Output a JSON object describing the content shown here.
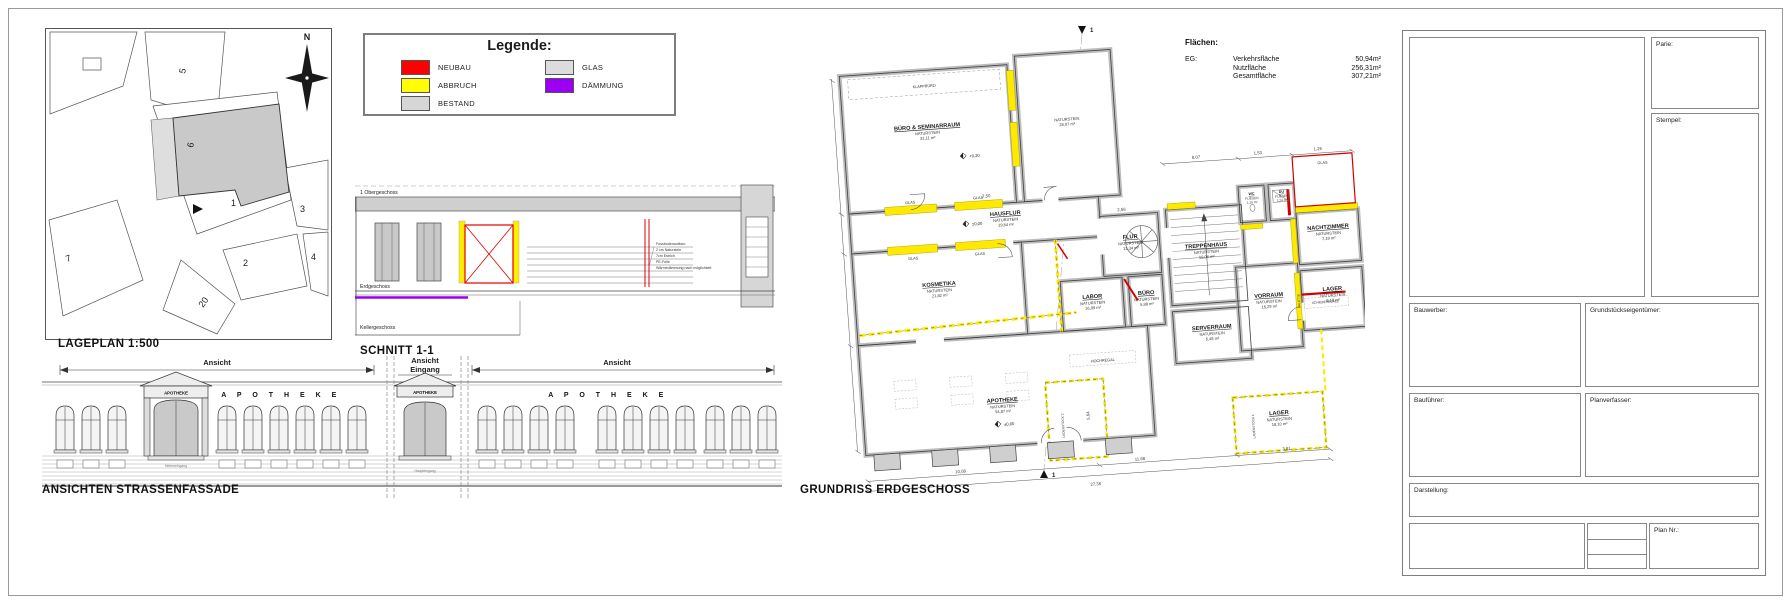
{
  "titles": {
    "lageplan": "LAGEPLAN 1:500",
    "schnitt": "SCHNITT 1-1",
    "ansichten": "ANSICHTEN STRASSENFASSADE",
    "grundriss": "GRUNDRISS ERDGESCHOSS"
  },
  "legende": {
    "title": "Legende:",
    "items": [
      {
        "label": "NEUBAU",
        "color": "#ff0000"
      },
      {
        "label": "ABBRUCH",
        "color": "#ffff00"
      },
      {
        "label": "BESTAND",
        "color": "#d6d6d6"
      },
      {
        "label": "GLAS",
        "color": "#dcdcdc"
      },
      {
        "label": "DÄMMUNG",
        "color": "#9b00f5"
      }
    ]
  },
  "lageplan": {
    "north": "N",
    "parcels": [
      "5",
      "6",
      "1",
      "3",
      "7",
      "2",
      "4",
      "20"
    ]
  },
  "schnitt": {
    "levels": [
      "1 Obergeschoss",
      "Erdgeschoss",
      "Kellergeschoss"
    ],
    "note": [
      "Fussbodenaufbau:",
      "2 cm Naturstein",
      "7cm Estrich",
      "PE-Folie",
      "Wärmedämmung nach möglichkeit"
    ]
  },
  "fassade": {
    "labels": {
      "left": "Ansicht",
      "mid1": "Ansicht",
      "mid2": "Eingang",
      "right": "Ansicht"
    },
    "lettering": "A P O T H E K E",
    "portal_sign": "APOTHEKE",
    "notes": {
      "left": "Nebeneingang",
      "mid": "Haupteingang"
    }
  },
  "grundriss": {
    "section_marker": "1",
    "rooms": [
      {
        "name": "BÜRO & SEMINARRAUM",
        "material": "NATURSTEIN",
        "area": "31,11 m²"
      },
      {
        "name": "PERSONALRAUM",
        "material": "NATURSTEIN",
        "area": "28,07 m²"
      },
      {
        "name": "HAUSFLUR",
        "material": "NATURSTEIN",
        "area": "19,54 m²"
      },
      {
        "name": "KOSMETIKA",
        "material": "NATURSTEIN",
        "area": "21,82 m²"
      },
      {
        "name": "FLUR",
        "material": "NATURSTEIN",
        "area": "13,34 m²"
      },
      {
        "name": "TREPPENHAUS",
        "material": "NATURSTEIN",
        "area": "15,06 m²"
      },
      {
        "name": "LABOR",
        "material": "NATURSTEIN",
        "area": "16,99 m²"
      },
      {
        "name": "BÜRO",
        "material": "NATURSTEIN",
        "area": "5,88 m²"
      },
      {
        "name": "SERVERRAUM",
        "material": "NATURSTEIN",
        "area": "5,48 m²"
      },
      {
        "name": "VORRAUM",
        "material": "NATURSTEIN",
        "area": "15,29 m²"
      },
      {
        "name": "WC",
        "material": "FLIESEN",
        "area": "1,19 m²"
      },
      {
        "name": "DU",
        "material": "FLIESEN",
        "area": "1,24 m²"
      },
      {
        "name": "NACHTZIMMER",
        "material": "NATURSTEIN",
        "area": "7,19 m²"
      },
      {
        "name": "LAGER",
        "material": "NATURSTEIN",
        "area": "6,18 m²"
      },
      {
        "name": "APOTHEKE",
        "material": "NATURSTEIN",
        "area": "94,87 m²"
      },
      {
        "name": "LAGER",
        "material": "NATURSTEIN",
        "area": "18,10 m²"
      }
    ],
    "annotations": {
      "klappbuero": "KLAPPBÜRO",
      "glas": "GLAS",
      "schieberegale": "SCHIEBEREGALE",
      "hochregal": "HOCHREGAL",
      "palette": "PALETTE",
      "ladenstock1": "LADENSTOCK 1",
      "ladenstock2": "LADENSTOCK 2"
    },
    "levels": {
      "seminarraum": "+0,20",
      "hausflur": "±0,00",
      "apotheke": "±0,00"
    },
    "dimensions": {
      "total": "27,36",
      "d1": "10,08",
      "d2": "11,88",
      "d3": "3,81",
      "d4": "8,07",
      "d5": "1,53",
      "d6": "1,26",
      "d7": "7,50",
      "d8": "2,56",
      "d9": "5,64"
    }
  },
  "flaechen": {
    "title": "Flächen:",
    "level": "EG:",
    "rows": [
      {
        "label": "Verkehrsfläche",
        "value": "50,94m²"
      },
      {
        "label": "Nutzfläche",
        "value": "256,31m²"
      },
      {
        "label": "Gesamtfläche",
        "value": "307,21m²"
      }
    ]
  },
  "titleblock": {
    "parie": "Parie:",
    "stempel": "Stempel:",
    "bauwerber": "Bauwerber:",
    "eigentuemer": "Grundstückseigentümer:",
    "baufuehrer": "Bauführer:",
    "planverfasser": "Planverfasser:",
    "darstellung": "Darstellung:",
    "plannr": "Plan Nr.:"
  }
}
